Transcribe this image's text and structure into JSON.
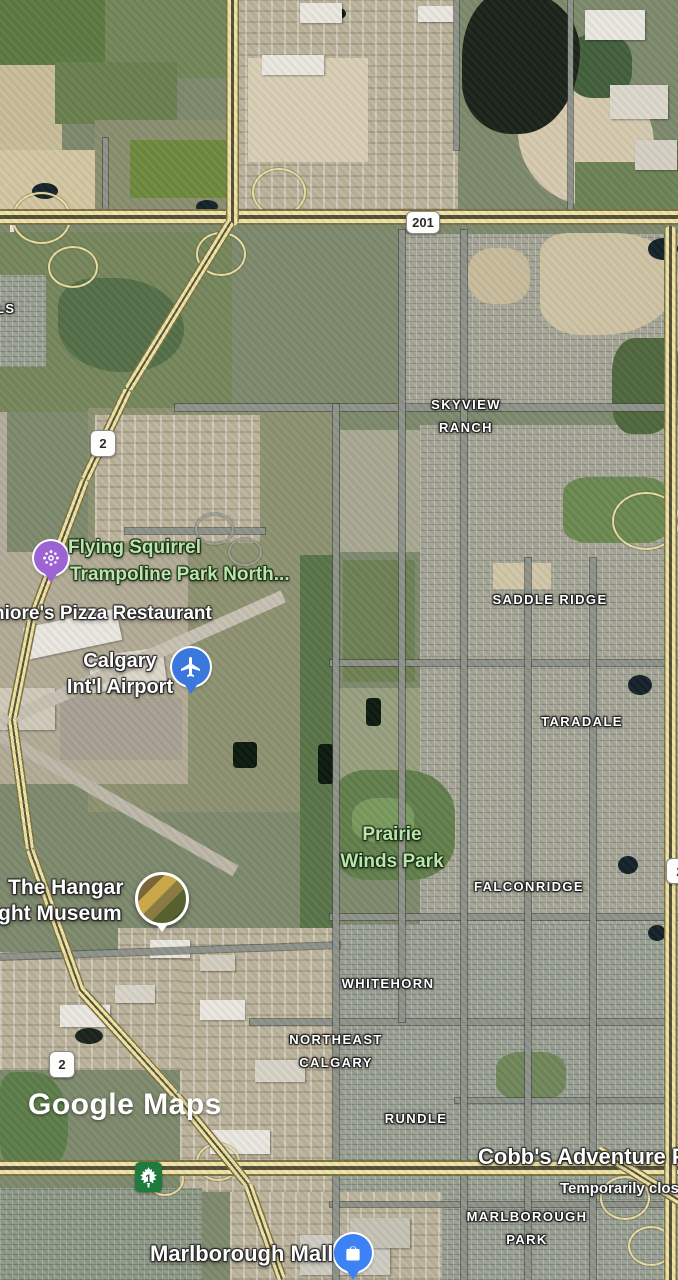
{
  "app": {
    "watermark": "Google Maps"
  },
  "shields": {
    "hwy_201": "201",
    "hwy_2_north": "2",
    "hwy_2_south": "2",
    "hwy_1": "1",
    "hwy_2_east_partial": "2"
  },
  "neighborhoods": {
    "partial_left": "LS",
    "skyview_line1": "SKYVIEW",
    "skyview_line2": "RANCH",
    "saddle_ridge": "SADDLE RIDGE",
    "taradale": "TARADALE",
    "falconridge": "FALCONRIDGE",
    "whitehorn": "WHITEHORN",
    "northeast_line1": "NORTHEAST",
    "northeast_line2": "CALGARY",
    "rundle": "RUNDLE",
    "marlborough_line1": "MARLBOROUGH",
    "marlborough_line2": "PARK"
  },
  "places": {
    "trampoline_line1": "Flying Squirrel",
    "trampoline_line2": "Trampoline Park North...",
    "pizza": "niore's Pizza Restaurant",
    "airport_line1": "Calgary",
    "airport_line2": "Int'l Airport",
    "prairie_line1": "Prairie",
    "prairie_line2": "Winds Park",
    "hangar_line1": "The Hangar",
    "hangar_line2": "ght Museum",
    "cobbs_name": "Cobb's Adventure Pa",
    "cobbs_status": "Temporarily clos",
    "mall": "Marlborough Mall"
  },
  "colors": {
    "poi_green_text": "#b9e6ad",
    "pin_purple": "#9d63d3",
    "pin_airport_blue": "#3b78dd",
    "pin_mall_blue": "#3d82f4",
    "highway_yellow": "#efe4a4",
    "tch_shield_green": "#1f7a3d"
  }
}
